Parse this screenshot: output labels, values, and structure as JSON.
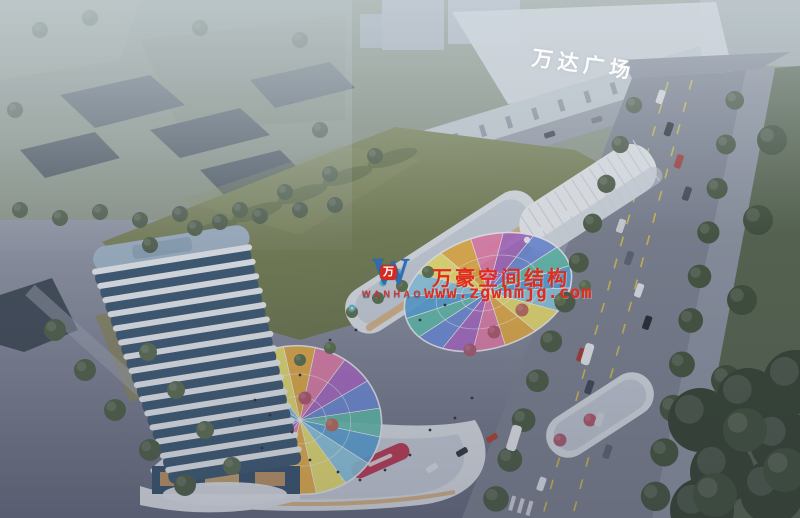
{
  "signs": {
    "mall_sign": "万达广场"
  },
  "watermark": {
    "logo_letter": "W",
    "logo_badge": "万",
    "logo_name": "WANHAO",
    "line1": "万豪空间结构",
    "line2": "www.zgwhmjg.com"
  },
  "colors": {
    "watermark_red": "#e02b1f",
    "logo_blue": "#2e6cb5",
    "mall_sign_white": "#ffffff",
    "lawn_green": "#7a8254",
    "road_gray": "#7e8391",
    "tree_green": "#46543c",
    "tower_glass": "#3b5872",
    "tower_band_white": "#eef2f5",
    "podium_white": "#e4e8ec",
    "accent_red_screen": "#c23750",
    "umbrella_teal": "#5fc0c6",
    "canopy_palette": [
      "#58a7dd",
      "#8fd0e8",
      "#f7ea6a",
      "#f2b23c",
      "#ef7fae",
      "#b06ac9",
      "#6f8fe0",
      "#62c4b1"
    ]
  }
}
